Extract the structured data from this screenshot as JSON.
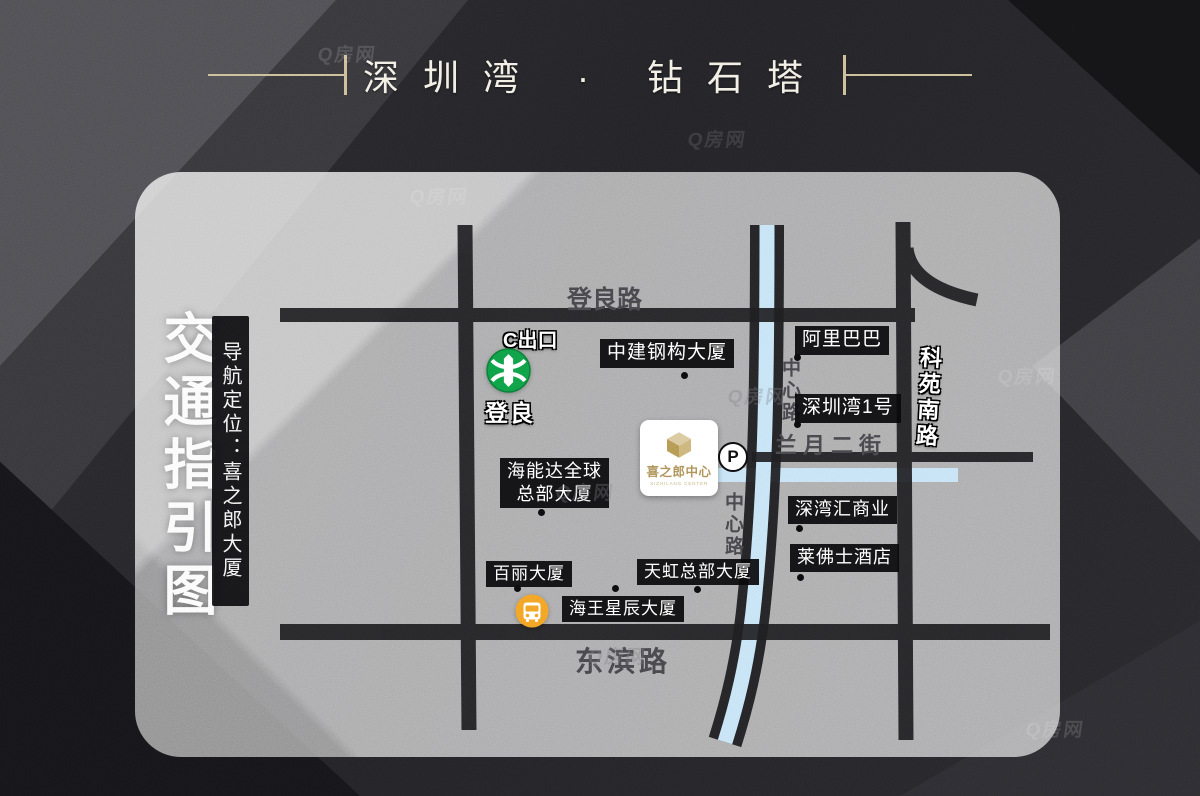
{
  "title": {
    "name": "深圳湾 · 钻石塔"
  },
  "legend": {
    "heading": "交通指引图",
    "locator": "导航定位：喜之郎大厦"
  },
  "metro": {
    "exit": "C出口",
    "station": "登良"
  },
  "roads": {
    "dengliang": "登良路",
    "dongbin": "东滨路",
    "keyuan_south": "科苑南路",
    "lanyue": "兰月二街",
    "zhongxin_upper": "中心路",
    "zhongxin_lower": "中心路"
  },
  "landmarks": [
    {
      "text": "中建钢构大厦"
    },
    {
      "text": "阿里巴巴"
    },
    {
      "text": "深圳湾1号"
    },
    {
      "text": "海能达全球\n总部大厦"
    },
    {
      "text": "深湾汇商业"
    },
    {
      "text": "莱佛士酒店"
    },
    {
      "text": "百丽大厦"
    },
    {
      "text": "天虹总部大厦"
    },
    {
      "text": "海王星辰大厦"
    }
  ],
  "center_card": {
    "name": "喜之郎中心",
    "subtext": "XIZHILANG CENTER"
  },
  "parking": {
    "label": "P"
  },
  "watermark": {
    "text": "Q房网"
  },
  "colors": {
    "accent_gold": "#cbbb96",
    "road_black": "#1e1e21",
    "river_blue": "#c5e3f5",
    "metro_green": "#0f9d45",
    "bus_orange": "#f2a024",
    "logo_gold": "#bfa26a"
  }
}
